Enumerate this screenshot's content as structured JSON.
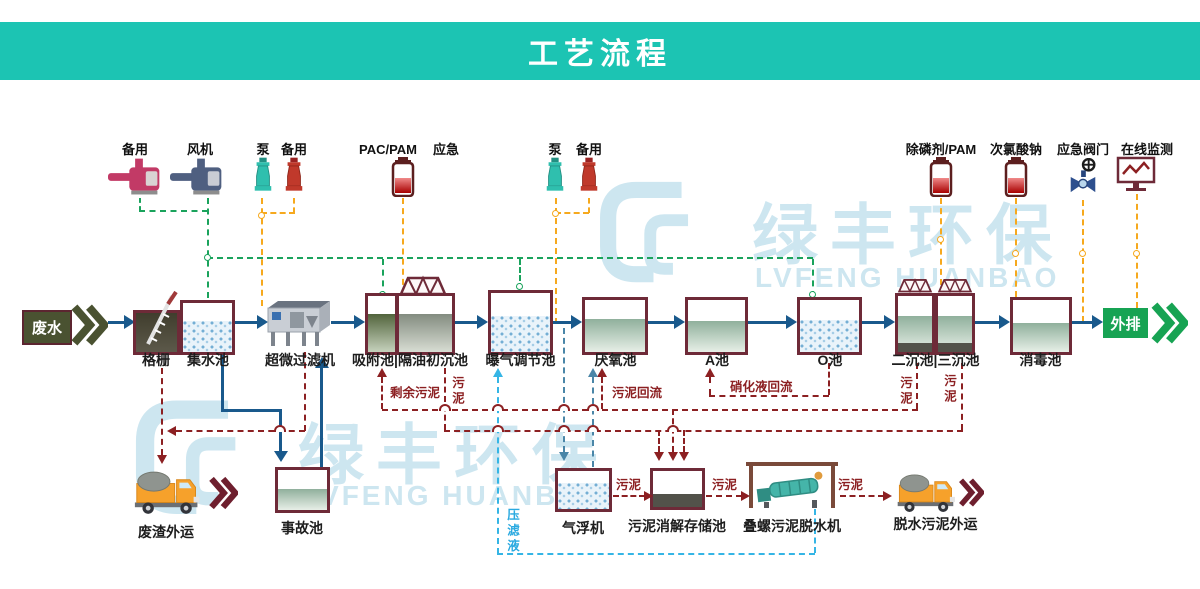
{
  "banner": {
    "title": "工艺流程"
  },
  "watermark": {
    "cn": "绿丰环保",
    "en": "LVFENG HUANBAO"
  },
  "top_equipment": {
    "standby1": "备用",
    "fan": "风机",
    "pump1": "泵",
    "standby2": "备用",
    "pac_pam": "PAC/PAM",
    "emergency": "应急",
    "pump2": "泵",
    "standby3": "备用",
    "phos_pam": "除磷剂/PAM",
    "naclo": "次氯酸钠",
    "valve": "应急阀门",
    "monitor": "在线监测"
  },
  "flow": {
    "influent": "废水",
    "outfall": "外排",
    "tanks": {
      "grid": "格栅",
      "collect": "集水池",
      "ultrafilter": "超微过滤机",
      "adsorb": "吸附池|隔油初沉池",
      "aeration": "曝气调节池",
      "anaerobic": "厌氧池",
      "a_tank": "A池",
      "o_tank": "O池",
      "settle": "二沉池|三沉池",
      "disinfect": "消毒池"
    }
  },
  "bottom": {
    "waste_out": "废渣外运",
    "accident": "事故池",
    "flotation": "气浮机",
    "sludge_store": "污泥消解存储池",
    "screw_press": "叠螺污泥脱水机",
    "sludge_out": "脱水污泥外运"
  },
  "stream_labels": {
    "sludge": "污泥",
    "excess_sludge": "剩余污泥",
    "sludge_return": "污泥回流",
    "nitrified_return": "硝化液回流",
    "filtrate": "压滤液"
  },
  "colors": {
    "banner": "#1cc4b3",
    "flow_blue": "#19598c",
    "air_green": "#1aa35c",
    "dosing_orange": "#f6a91e",
    "sludge_red": "#8c2022",
    "scum_blue": "#4a86a8",
    "filtrate_cyan": "#35b5e5",
    "tank_border": "#6e2a38",
    "influent_olive": "#4a5231",
    "outfall_green": "#17a353",
    "watermark": "#cde6f0"
  }
}
